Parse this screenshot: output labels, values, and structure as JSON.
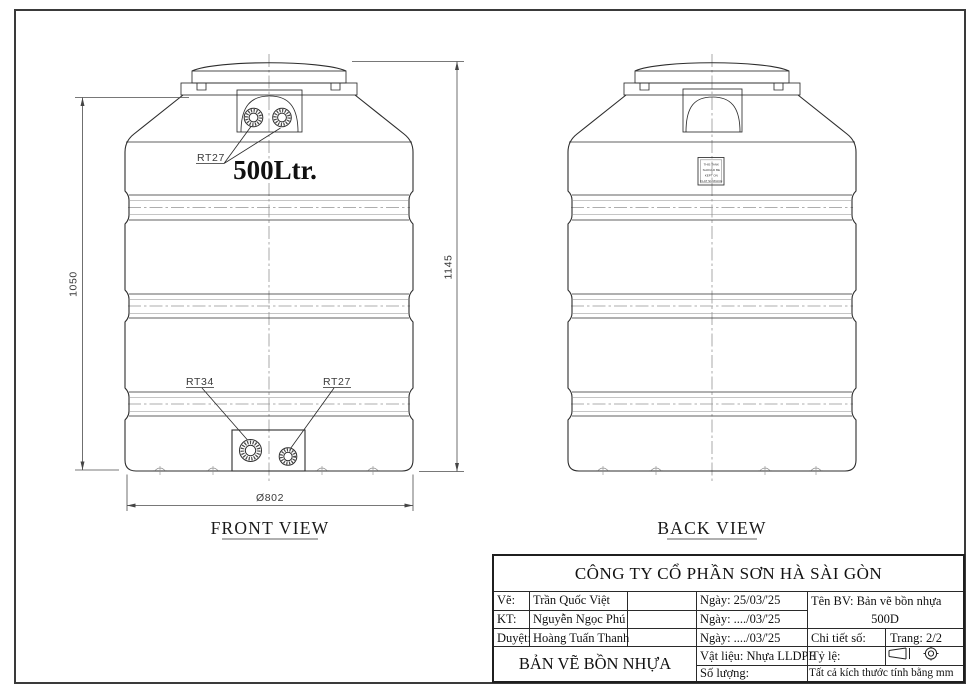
{
  "front_view": {
    "caption": "FRONT VIEW",
    "volume": "500Ltr.",
    "top_fittings_label": "RT27",
    "bottom_left_fitting_label": "RT34",
    "bottom_right_fitting_label": "RT27",
    "dims": {
      "body_height": "1050",
      "total_height": "1145",
      "diameter": "Ø802"
    }
  },
  "back_view": {
    "caption": "BACK VIEW",
    "plate_lines": [
      "THIS TANK",
      "SHOULD BE",
      "KEPT ON",
      "FLAT SURFACE"
    ]
  },
  "title_block": {
    "company": "CÔNG TY CỔ PHẦN SƠN HÀ SÀI GÒN",
    "sign_rows": [
      {
        "role": "Vẽ:",
        "name": "Trần Quốc Việt",
        "date": "Ngày: 25/03/'25"
      },
      {
        "role": "KT:",
        "name": "Nguyễn Ngọc Phú",
        "date": "Ngày: ..../03/'25"
      },
      {
        "role": "Duyệt:",
        "name": "Hoàng Tuấn Thanh",
        "date": "Ngày: ..../03/'25"
      }
    ],
    "drawing_name": "Tên BV: Bản vẽ bồn nhựa",
    "model": "500D",
    "detail_no": "Chi tiết số:",
    "page": "Trang: 2/2",
    "material": "Vật liệu: Nhựa LLDPE",
    "scale": "Tỷ lệ:",
    "quantity": "Số lượng:",
    "units_note": "Tất cả kích thước tính bằng mm",
    "sheet_title": "BẢN VẼ BỒN NHỰA"
  }
}
